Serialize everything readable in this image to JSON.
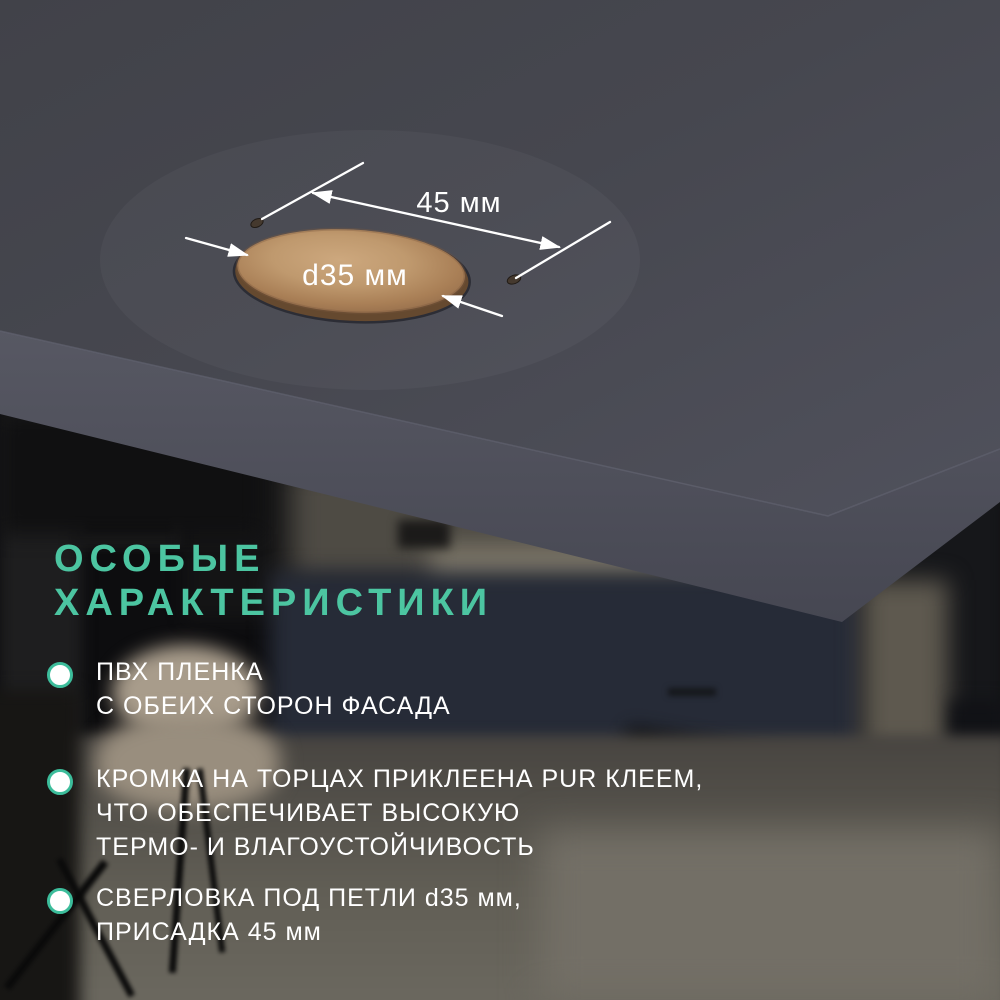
{
  "annotations": {
    "spacing_label": "45 мм",
    "diameter_label": "d35 мм"
  },
  "heading": {
    "line1": "ОСОБЫЕ",
    "line2": "ХАРАКТЕРИСТИКИ"
  },
  "features": [
    {
      "lines": [
        "ПВХ ПЛЕНКА",
        "С ОБЕИХ СТОРОН ФАСАДА"
      ]
    },
    {
      "lines": [
        "КРОМКА НА ТОРЦАХ ПРИКЛЕЕНА PUR КЛЕЕМ,",
        "ЧТО ОБЕСПЕЧИВАЕТ ВЫСОКУЮ",
        "ТЕРМО- И ВЛАГОУСТОЙЧИВОСТЬ"
      ]
    },
    {
      "lines": [
        "СВЕРЛОВКА ПОД ПЕТЛИ d35 мм,",
        "ПРИСАДКА 45 мм"
      ]
    }
  ],
  "colors": {
    "accent": "#4cc5a1",
    "text": "#ffffff",
    "panel_face": "#45464f",
    "panel_edge": "#50515c",
    "hole_wood": "#bb9268",
    "background": "#0d0d0f"
  }
}
